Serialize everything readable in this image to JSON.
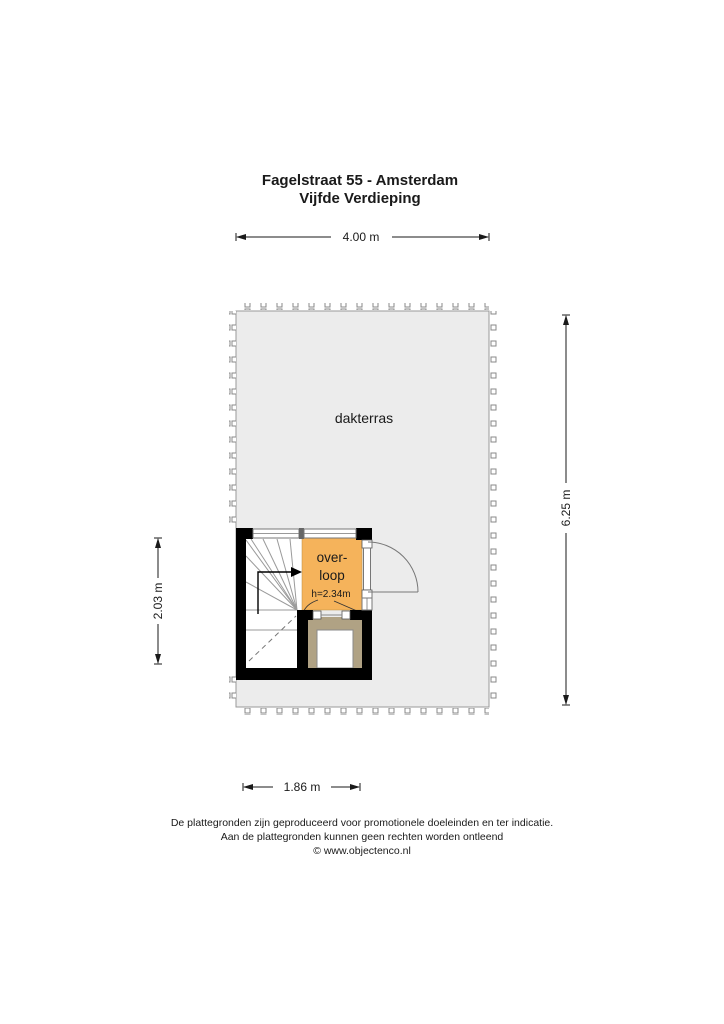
{
  "title": {
    "line1": "Fagelstraat 55 - Amsterdam",
    "line2": "Vijfde Verdieping"
  },
  "plan": {
    "terrace_label": "dakterras",
    "landing": {
      "label_line1": "over-",
      "label_line2": "loop",
      "height_note": "h=2.34m"
    }
  },
  "dimensions": {
    "top": "4.00 m",
    "right": "6.25 m",
    "left": "2.03 m",
    "bottom": "1.86 m"
  },
  "footer": {
    "line1": "De plattegronden zijn geproduceerd voor promotionele doeleinden en ter indicatie.",
    "line2": "Aan de plattegronden kunnen geen rechten worden ontleend",
    "line3": "© www.objectenco.nl"
  },
  "colors": {
    "wall": "#000000",
    "terrace_fill": "#ececec",
    "terrace_border": "#9a9a9a",
    "landing_fill": "#f5b35b",
    "shaft_fill": "#b0a284",
    "stair_line": "#9a9a9a",
    "dim_line": "#1a1a1a",
    "text": "#1a1a1a"
  }
}
